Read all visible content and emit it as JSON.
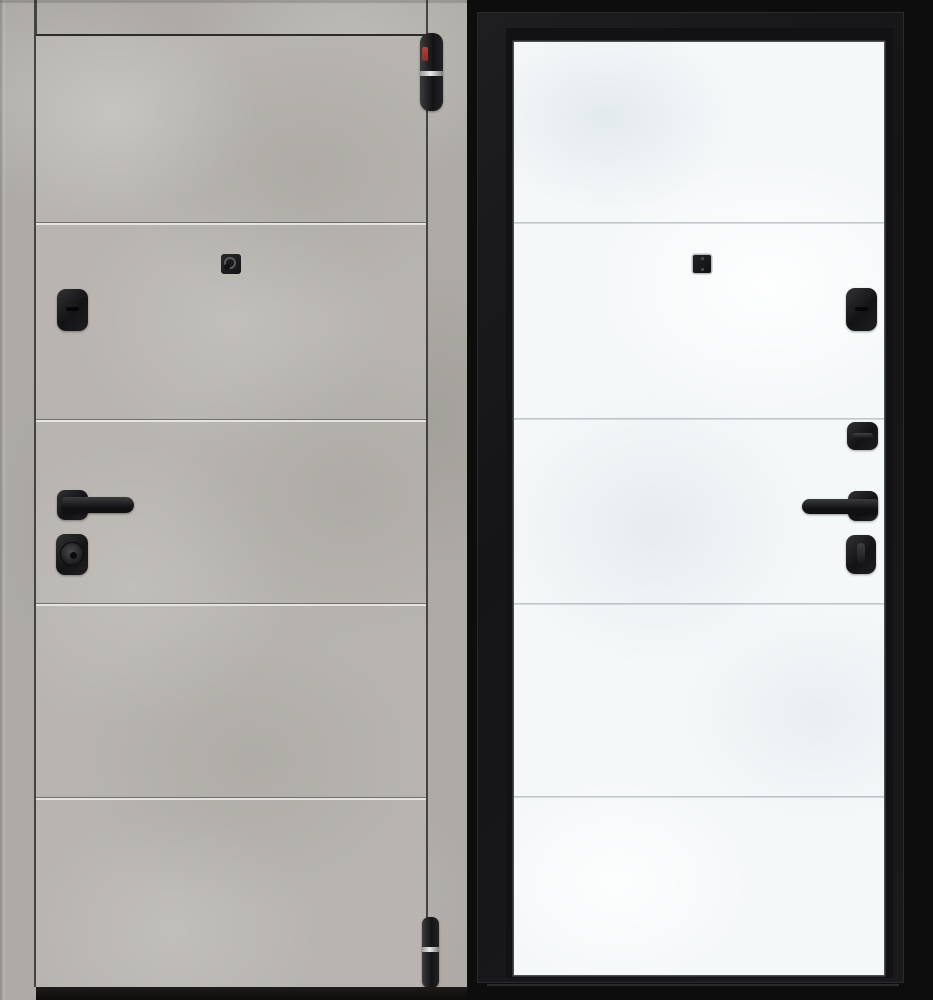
{
  "photo": {
    "subject": "entry-door-shown-from-both-sides",
    "colors": {
      "outside_finish": "#b6b3ae",
      "inside_finish": "#f5f8f9",
      "frame": "#161618",
      "hardware": "#1a1a1c",
      "hinge_brand_label": "#a23a34",
      "hinge_ring": "#d9d9d9",
      "backdrop": "#0d0d0e"
    },
    "outside": {
      "name": "outside-view-grey-concrete-door",
      "groove_count": 4,
      "hardware": [
        {
          "name": "top-hinge"
        },
        {
          "name": "peephole"
        },
        {
          "name": "keyhole-escutcheon"
        },
        {
          "name": "lever-handle"
        },
        {
          "name": "cylinder-knob"
        },
        {
          "name": "bottom-hinge"
        }
      ]
    },
    "inside": {
      "name": "inside-view-white-door-black-frame",
      "groove_count": 4,
      "hardware": [
        {
          "name": "lock-plate"
        },
        {
          "name": "keyhole-escutcheon"
        },
        {
          "name": "deadbolt-thumbturn"
        },
        {
          "name": "lever-handle"
        },
        {
          "name": "night-latch-thumbturn"
        }
      ]
    }
  }
}
